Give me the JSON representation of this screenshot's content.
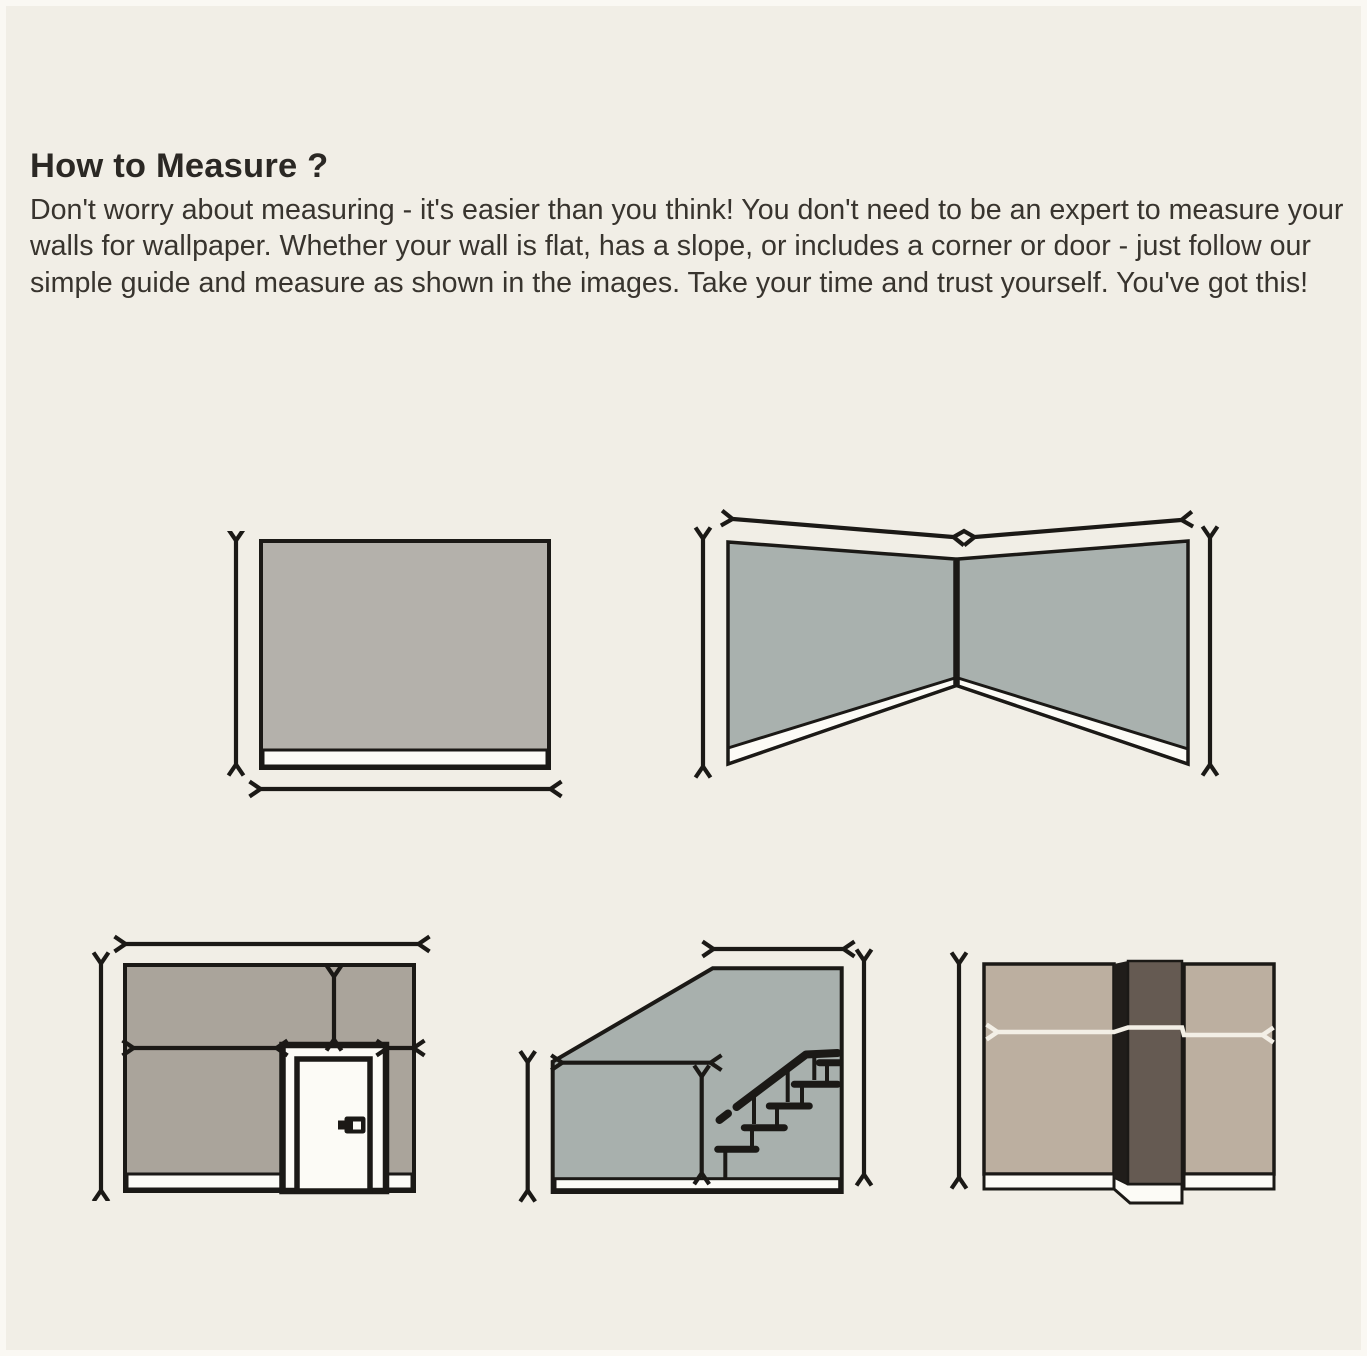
{
  "header": {
    "title": "How to Measure ?",
    "description": "Don't worry about measuring - it's easier than you think! You don't need to be an expert to measure your walls for wallpaper. Whether your wall is flat, has a slope, or includes a corner or door - just follow our simple guide and measure as shown in the images. Take your time and trust yourself. You've got this!"
  },
  "colors": {
    "background": "#f1eee6",
    "ink": "#1b1916",
    "baseboard_white": "#fcfbf6",
    "wall_flat": "#b4b1ab",
    "wall_corner": "#a9b1ae",
    "wall_door": "#aaa49b",
    "wall_stairs": "#a8b0ad",
    "wall_column": "#bcafa0",
    "column_front": "#655a52",
    "column_side": "#201d1a",
    "white_arrow": "#f3efe6"
  },
  "diagrams": [
    {
      "name": "flat-wall",
      "label": "flat wall with height and width measure arrows"
    },
    {
      "name": "corner-wall",
      "label": "two walls meeting in a corner, measure each wall width and height"
    },
    {
      "name": "wall-with-door",
      "label": "wall containing a door, measure segments around the door"
    },
    {
      "name": "wall-with-staircase-slope",
      "label": "sloped wall along a staircase, measure part heights and widths"
    },
    {
      "name": "wall-with-column",
      "label": "wall with protruding column, measure width across the column"
    }
  ]
}
